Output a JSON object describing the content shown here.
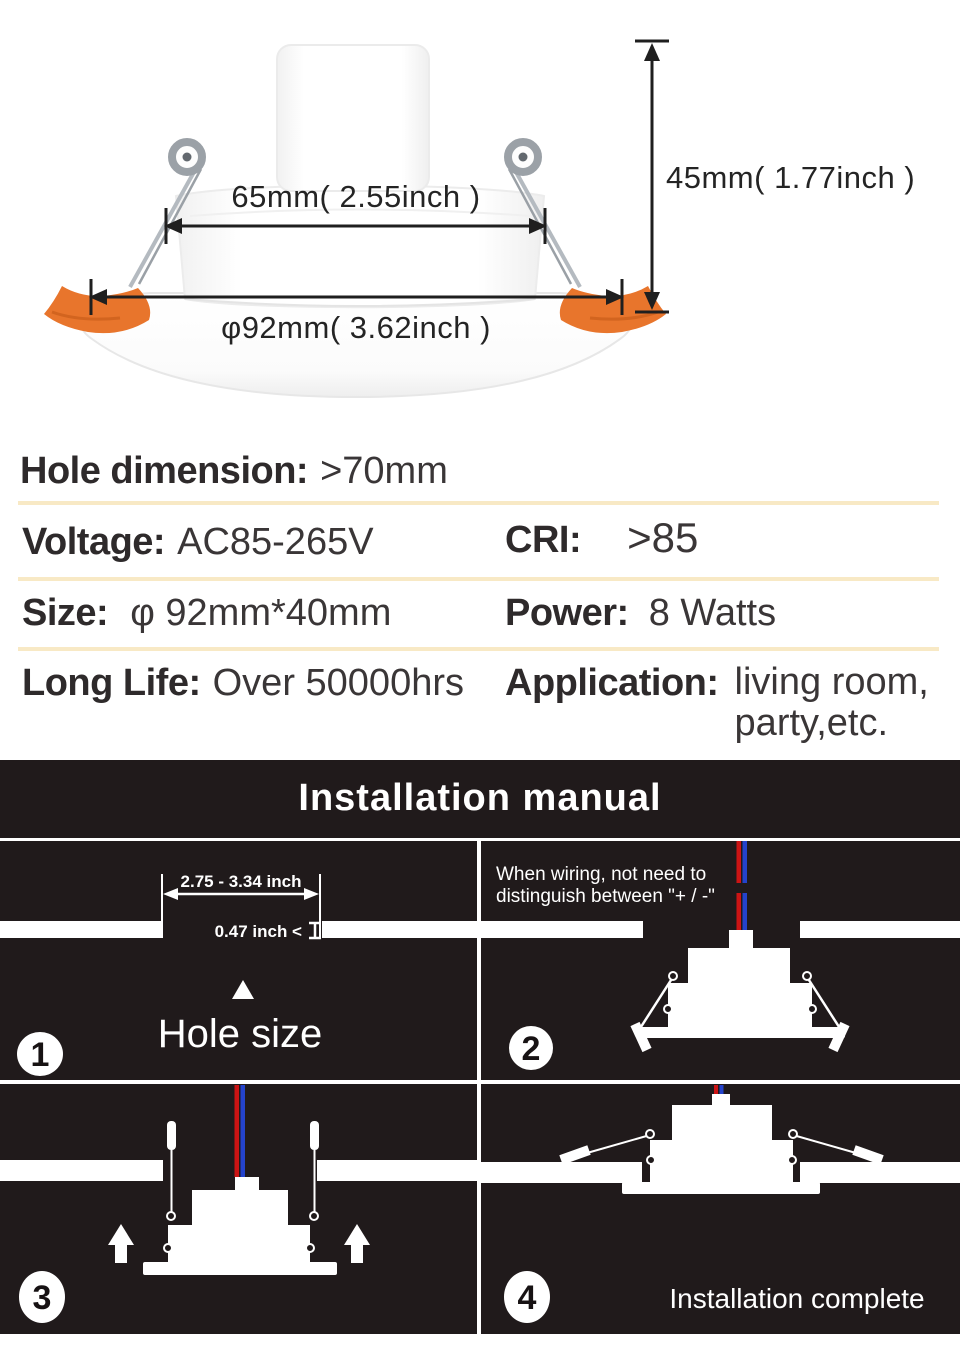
{
  "diagram": {
    "top_width_label": "65mm( 2.55inch )",
    "bottom_diameter_label": "φ92mm( 3.62inch )",
    "height_label": "45mm( 1.77inch )"
  },
  "specs": {
    "hole_dimension": {
      "label": "Hole dimension:",
      "value": ">70mm"
    },
    "voltage": {
      "label": "Voltage:",
      "value": "AC85-265V"
    },
    "cri": {
      "label": "CRI:",
      "value": ">85"
    },
    "size": {
      "label": "Size:",
      "value": "φ 92mm*40mm"
    },
    "power": {
      "label": "Power:",
      "value": "8 Watts"
    },
    "long_life": {
      "label": "Long Life:",
      "value": "Over 50000hrs"
    },
    "application": {
      "label": "Application:",
      "line1": "living room,",
      "line2": "party,etc."
    }
  },
  "installation": {
    "title": "Installation manual",
    "step1": {
      "number": "1",
      "hole_width": "2.75 - 3.34 inch",
      "ceiling_thickness": "0.47 inch <",
      "caption": "Hole size"
    },
    "step2": {
      "number": "2",
      "note_line1": "When wiring, not need to",
      "note_line2": "distinguish between \"+ / -\""
    },
    "step3": {
      "number": "3"
    },
    "step4": {
      "number": "4",
      "caption": "Installation complete"
    }
  },
  "colors": {
    "page_background": "#ffffff",
    "manual_background": "#201a1b",
    "divider": "#f8e9c5",
    "clip_orange": "#e8752c",
    "wire_red": "#cc1414",
    "wire_blue": "#2443cc",
    "text_dark": "#333031",
    "text_white": "#ffffff"
  }
}
